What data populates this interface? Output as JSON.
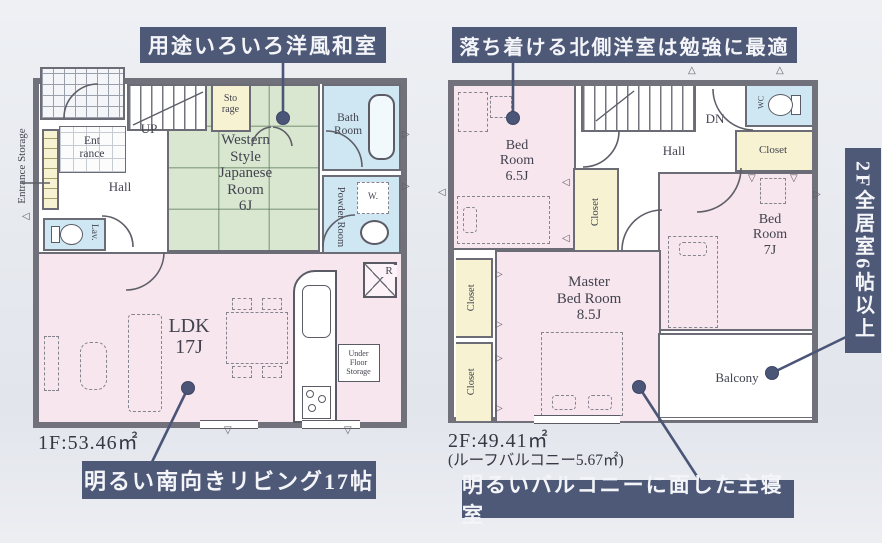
{
  "colors": {
    "navy": "#4a5577",
    "wall": "#70717b",
    "room_pink": "#f8e6ee",
    "tatami_green": "#d9e7d1",
    "closet_yellow": "#f6f2d2",
    "bath_blue": "#cfe7f2",
    "background": "#e7eaef"
  },
  "icons": {
    "marker_right": "▷",
    "marker_left": "◁",
    "marker_up": "△",
    "marker_down": "▽"
  },
  "callouts": {
    "japanese_room": "用途いろいろ洋風和室",
    "north_bedroom": "落ち着ける北側洋室は勉強に最適",
    "living": "明るい南向きリビング17帖",
    "master_bedroom": "明るいバルコニーに面した主寝室",
    "banner_2f": "2F全居室6帖以上"
  },
  "floor1": {
    "area": "1F:53.46㎡",
    "rooms": {
      "entrance_storage": "Entrance Storage",
      "entrance": "Ent\nrance",
      "hall": "Hall",
      "stairs": "UP",
      "storage": "Sto\nrage",
      "japanese_room": "Western\nStyle\nJapanese\nRoom\n6J",
      "bath": "Bath\nRoom",
      "powder": "Powder Room",
      "lavatory": "Lav.",
      "washer": "W.",
      "ldk": "LDK\n17J",
      "under_floor_storage": "Under\nFloor\nStorage",
      "refrigerator": "R"
    }
  },
  "floor2": {
    "area": "2F:49.41㎡",
    "area_note": "(ルーフバルコニー5.67㎡)",
    "rooms": {
      "bedroom_65": "Bed\nRoom\n6.5J",
      "stairs": "DN",
      "hall": "Hall",
      "wc": "WC",
      "closet_hall": "Closet",
      "closet_mid": "Closet",
      "bedroom_7": "Bed\nRoom\n7J",
      "master_bedroom": "Master\nBed Room\n8.5J",
      "closet_west_1": "Closet",
      "closet_west_2": "Closet",
      "balcony": "Balcony"
    }
  }
}
